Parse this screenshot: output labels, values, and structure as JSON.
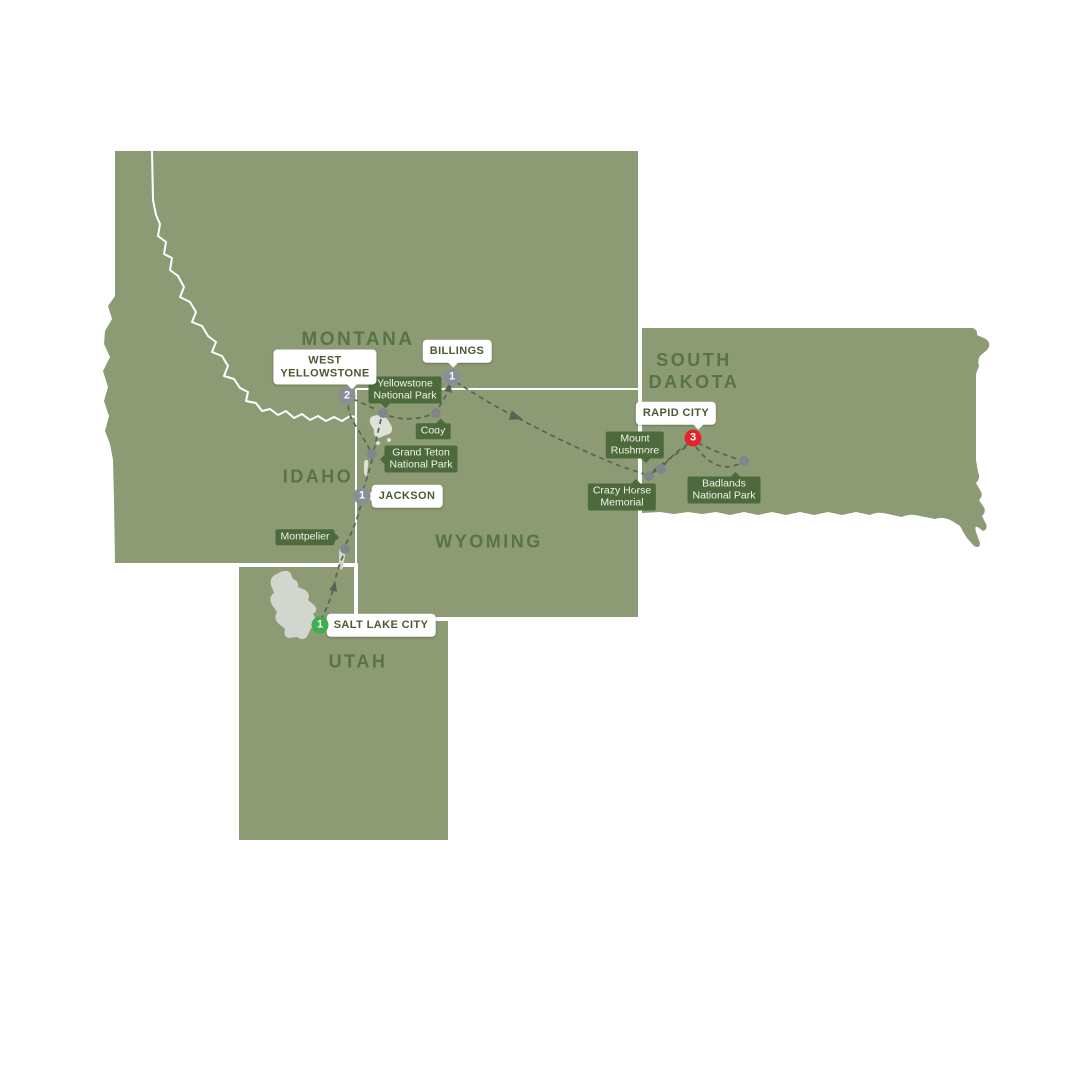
{
  "map": {
    "colors": {
      "background": "#FFFFFF",
      "land": "#8D9B74",
      "state_border": "#FFFFFF",
      "state_label": "#587345",
      "poi_badge_bg": "#4D6A3D",
      "poi_badge_text": "#F2F3E9",
      "callout_bg": "#FFFFFF",
      "callout_text": "#4B5A33",
      "route": "#5C6155",
      "lake": "#D3D6CE",
      "yellowstone_lake": "#DEE1D7",
      "stop_default": "#8A8E98",
      "stop_start": "#3DAF4C",
      "stop_end": "#E3242F",
      "poi_dot": "#80858E"
    },
    "states": [
      {
        "name": "montana",
        "label": "MONTANA"
      },
      {
        "name": "idaho",
        "label": "IDAHO"
      },
      {
        "name": "wyoming",
        "label": "WYOMING"
      },
      {
        "name": "utah",
        "label": "UTAH"
      },
      {
        "name": "south-dakota",
        "line1": "SOUTH",
        "line2": "DAKOTA"
      }
    ],
    "stops": [
      {
        "name": "salt-lake-city",
        "label": "SALT LAKE CITY",
        "nights": "1",
        "kind": "start"
      },
      {
        "name": "jackson",
        "label": "JACKSON",
        "nights": "1",
        "kind": "overnight"
      },
      {
        "name": "west-yellowstone",
        "line1": "WEST",
        "line2": "YELLOWSTONE",
        "nights": "2",
        "kind": "overnight"
      },
      {
        "name": "billings",
        "label": "BILLINGS",
        "nights": "1",
        "kind": "overnight"
      },
      {
        "name": "rapid-city",
        "label": "RAPID CITY",
        "nights": "3",
        "kind": "end"
      }
    ],
    "pois": [
      {
        "name": "montpelier",
        "line1": "Montpelier"
      },
      {
        "name": "grand-teton",
        "line1": "Grand Teton",
        "line2": "National Park"
      },
      {
        "name": "yellowstone",
        "line1": "Yellowstone",
        "line2": "National Park"
      },
      {
        "name": "cody",
        "line1": "Cody"
      },
      {
        "name": "mount-rushmore",
        "line1": "Mount",
        "line2": "Rushmore"
      },
      {
        "name": "crazy-horse",
        "line1": "Crazy Horse",
        "line2": "Memorial"
      },
      {
        "name": "badlands",
        "line1": "Badlands",
        "line2": "National Park"
      }
    ]
  }
}
